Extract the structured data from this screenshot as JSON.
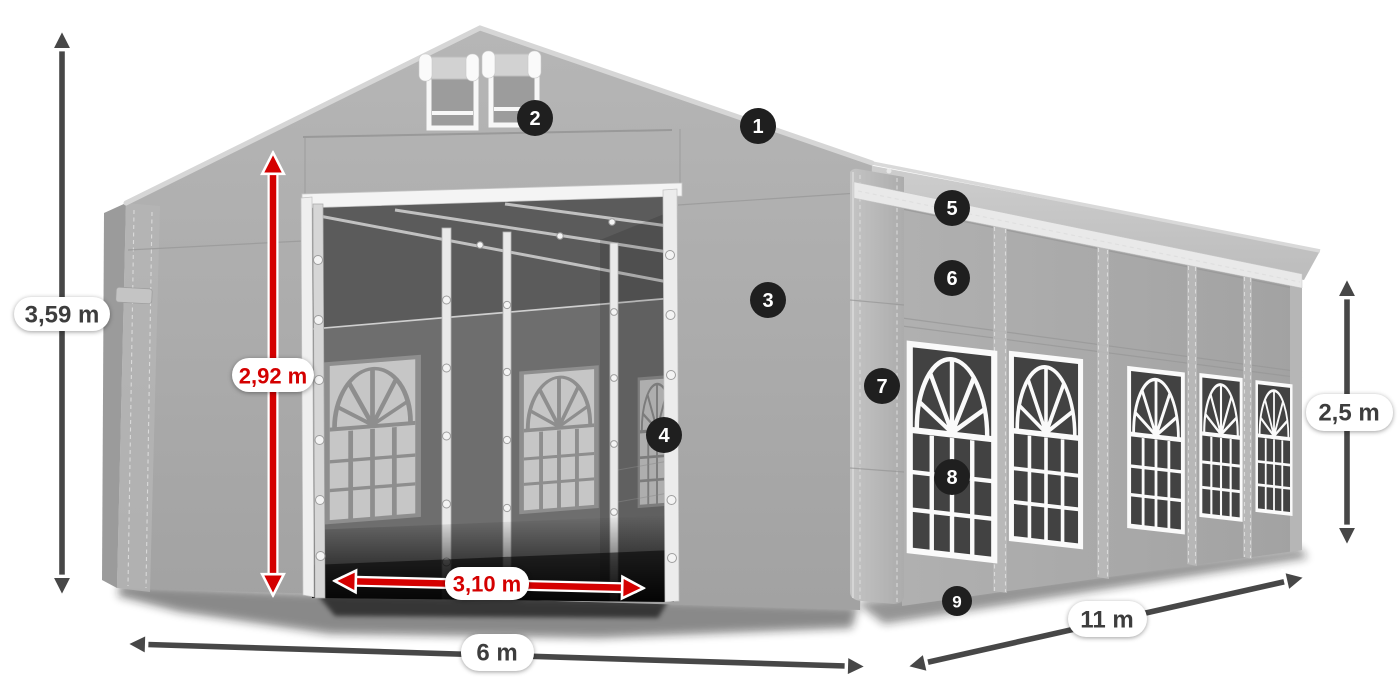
{
  "diagram": {
    "kind": "tent-dimension-diagram",
    "colors": {
      "accent_red": "#d40000",
      "arrow_dark": "#474747",
      "badge_bg": "#1f1f1f",
      "badge_text": "#ffffff",
      "label_text": "#3d3d3d",
      "label_pill_bg": "#ffffff",
      "tent_gray": "#aaaaaa",
      "roof_gray": "#c7c7c7",
      "interior_gray": "#6e6e6e"
    }
  },
  "dimensions": {
    "total_height": "3,59 m",
    "entrance_height": "2,92 m",
    "entrance_width": "3,10 m",
    "front_width": "6 m",
    "side_length": "11 m",
    "side_height": "2,5 m"
  },
  "badges": [
    {
      "number": "1"
    },
    {
      "number": "2"
    },
    {
      "number": "3"
    },
    {
      "number": "4"
    },
    {
      "number": "5"
    },
    {
      "number": "6"
    },
    {
      "number": "7"
    },
    {
      "number": "8"
    },
    {
      "number": "9"
    }
  ]
}
